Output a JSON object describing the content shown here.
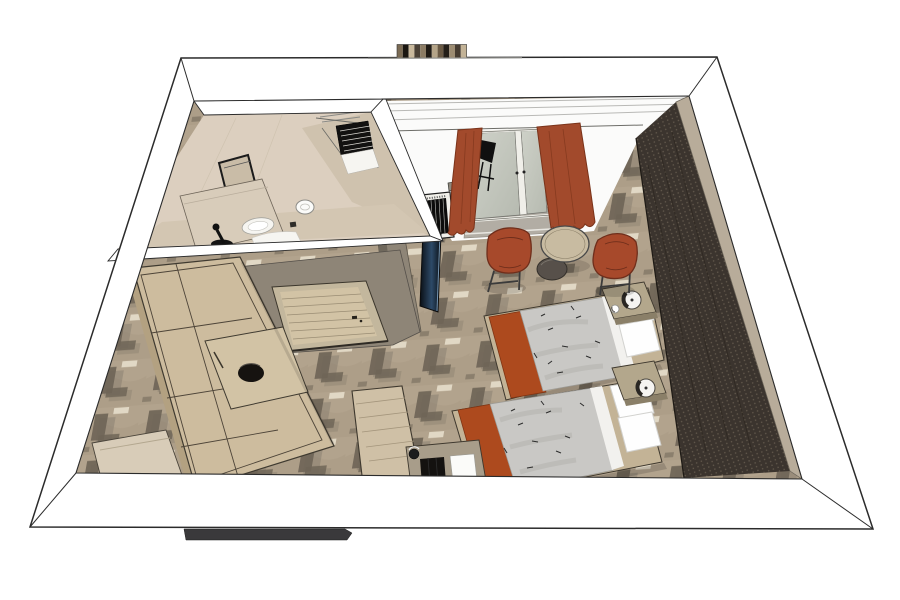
{
  "scene": {
    "kind": "3d-cutaway-floorplan-render",
    "style": "sketchup",
    "rooms": [
      {
        "name": "bathroom"
      },
      {
        "name": "entry"
      },
      {
        "name": "twin-bedroom"
      }
    ],
    "furniture": [
      "wardrobe",
      "decor-bowl",
      "entry-door",
      "tv-panel",
      "ac-grille",
      "balcony-door",
      "balcony-chair",
      "curtain-left",
      "curtain-right",
      "lounge-chair-left",
      "lounge-chair-right",
      "round-table",
      "ottoman",
      "twin-bed-1",
      "twin-bed-2",
      "nightstand-1",
      "nightstand-2",
      "table-lamp-1",
      "table-lamp-2",
      "cup",
      "desk",
      "minibar-cabinet",
      "kettle",
      "luggage-bench",
      "vanity-counter",
      "mirror",
      "sink",
      "faucet",
      "toilet",
      "shower-grate",
      "towel-rail",
      "headboard-accent-wall",
      "patterned-carpet",
      "roof-vent-strip",
      "threshold-bar"
    ]
  },
  "colors": {
    "outline": "#2b2b2b",
    "wall_white": "#ffffff",
    "wall_face": "#fbfbfa",
    "band_line": "#b9b9b6",
    "band_line_dark": "#6d6d68",
    "partition": "#8e8577",
    "partition_dark": "#6f685c",
    "bath_floor": "#dccfbf",
    "bath_face_right": "#cfc2ae",
    "bath_face_near": "#d3c6b2",
    "bath_counter": "#d8ccba",
    "fixture_white": "#f6f5f1",
    "carpet_base": "#b2a38d",
    "carpet_mottle": "#a4957f",
    "carpet_dark": "#6f6557",
    "carpet_shadow": "#8b8070",
    "carpet_cream": "#e7decb",
    "curtain": "#a24a2c",
    "curtain_dark": "#7a331a",
    "glass_frame": "#f0efe9",
    "balcony_floor": "#b2ada4",
    "accent_wall": "#3b342e",
    "accent_wall_dot": "#6b6052",
    "accent_wall_trim": "#b8ac9a",
    "wood": "#cdbc9e",
    "wood_dark": "#b3a181",
    "wood_line": "#4d4438",
    "door_wood": "#d2c3a5",
    "bed_frame": "#c3b396",
    "duvet": "#c9c8c5",
    "duvet_mottle": "#b2b1ad",
    "sheet": "#f2f1ee",
    "pillow": "#fefefe",
    "runner": "#ad4a1e",
    "runner_dark": "#7e3413",
    "nightstand": "#b3a78c",
    "nightstand_front": "#8a7f68",
    "lamp": "#f5f4f1",
    "lamp_dark": "#2a2723",
    "chair": "#a7492b",
    "chair_dark": "#6f2e1b",
    "table_top": "#c8bba1",
    "ottoman": "#57504a",
    "tv_blue": "#27405a",
    "ac_black": "#0c0c0b"
  }
}
